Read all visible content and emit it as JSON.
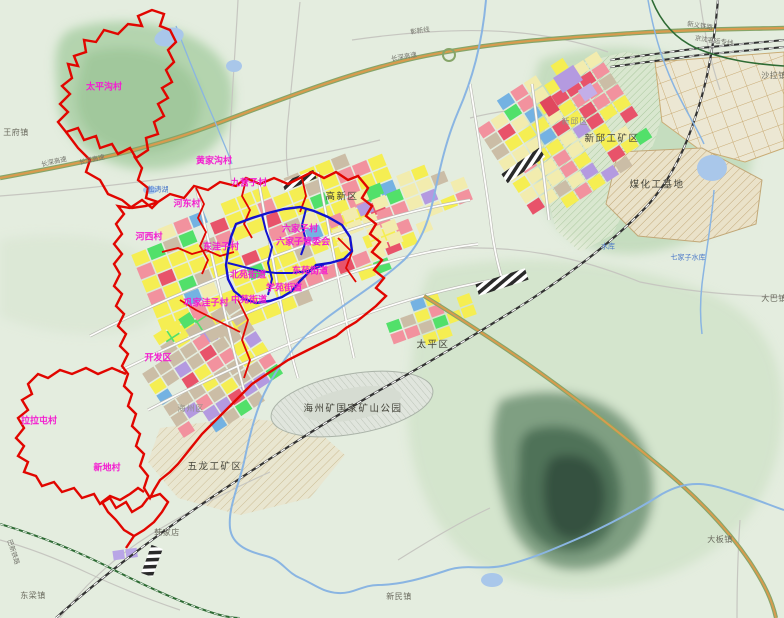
{
  "map": {
    "kind": "urban-master-plan-map",
    "palette": {
      "boundary_red": "#e10600",
      "boundary_blue": "#1212cf",
      "village_label": "#f31fd0",
      "district_label": "#44443a",
      "town_label": "#6a6a5e",
      "water_label": "#4a78c8",
      "road_label": "#73736b",
      "expressway_core": "#d89b4e",
      "expressway_edge": "#86a569",
      "urban_yellow": "#f5ee52",
      "urban_pale_yellow": "#f2ecae",
      "urban_pink": "#f2929e",
      "urban_red": "#e8536a",
      "urban_green": "#52e06a",
      "urban_tan": "#cbbda6",
      "urban_blue": "#74b2e2",
      "urban_purple": "#b49ae0",
      "water": "#8ab5e2",
      "forest": "#9cc497",
      "dark_mountain": "#4f7259"
    },
    "labels": [
      {
        "name": "village-taipinggou",
        "text": "太平沟村",
        "type": "village",
        "x": 104,
        "y": 88
      },
      {
        "name": "village-huangjiagou",
        "text": "黄家沟村",
        "type": "village",
        "x": 214,
        "y": 162
      },
      {
        "name": "village-jiuyingzi",
        "text": "九营子村",
        "type": "village",
        "x": 249,
        "y": 184
      },
      {
        "name": "village-hedong",
        "text": "河东村",
        "type": "village",
        "x": 187,
        "y": 205
      },
      {
        "name": "village-hexi",
        "text": "河西村",
        "type": "village",
        "x": 149,
        "y": 238
      },
      {
        "name": "village-dongwazi",
        "text": "东洼子村",
        "type": "village",
        "x": 221,
        "y": 248
      },
      {
        "name": "village-liujiazi",
        "text": "六家子村",
        "type": "village",
        "x": 300,
        "y": 230
      },
      {
        "name": "committee-liujiazi",
        "text": "六家子管委会",
        "type": "village",
        "x": 303,
        "y": 243
      },
      {
        "name": "subdistrict-beiyuan",
        "text": "北苑街道",
        "type": "village",
        "x": 248,
        "y": 276
      },
      {
        "name": "subdistrict-dongyuan",
        "text": "东苑街道",
        "type": "village",
        "x": 310,
        "y": 272
      },
      {
        "name": "subdistrict-xueyuan",
        "text": "学苑街道",
        "type": "village",
        "x": 284,
        "y": 289
      },
      {
        "name": "subdistrict-zhongyuan",
        "text": "中苑街道",
        "type": "village",
        "x": 249,
        "y": 301
      },
      {
        "name": "village-gongjiawazi",
        "text": "巩家洼子村",
        "type": "village",
        "x": 206,
        "y": 304
      },
      {
        "name": "zone-kaifaqu",
        "text": "开发区",
        "type": "village",
        "x": 158,
        "y": 359
      },
      {
        "name": "village-lalatun",
        "text": "拉拉屯村",
        "type": "village",
        "x": 39,
        "y": 422
      },
      {
        "name": "village-xindi",
        "text": "新地村",
        "type": "village",
        "x": 107,
        "y": 469
      },
      {
        "name": "district-gaoxinqu",
        "text": "高新区",
        "type": "district",
        "x": 342,
        "y": 197
      },
      {
        "name": "district-taipingqu",
        "text": "太平区",
        "type": "district",
        "x": 433,
        "y": 345
      },
      {
        "name": "district-xinqiu-mining",
        "text": "新邱工矿区",
        "type": "district",
        "x": 612,
        "y": 139
      },
      {
        "name": "district-coal-chemical-base",
        "text": "煤化工基地",
        "type": "district",
        "x": 657,
        "y": 185
      },
      {
        "name": "district-wulong-mining",
        "text": "五龙工矿区",
        "type": "district",
        "x": 215,
        "y": 467
      },
      {
        "name": "park-haizhou-mine",
        "text": "海州矿国家矿山公园",
        "type": "district",
        "x": 353,
        "y": 409
      },
      {
        "name": "district-haizhouqu",
        "text": "海州区",
        "type": "district-faint",
        "x": 191,
        "y": 409
      },
      {
        "name": "district-xinqiuqu",
        "text": "新邱区",
        "type": "district-faint",
        "x": 575,
        "y": 122
      },
      {
        "name": "town-wangfu",
        "text": "王府镇",
        "type": "town",
        "x": 16,
        "y": 133
      },
      {
        "name": "town-dongliang",
        "text": "东梁镇",
        "type": "town",
        "x": 33,
        "y": 596
      },
      {
        "name": "town-xinmin",
        "text": "新民镇",
        "type": "town",
        "x": 399,
        "y": 597
      },
      {
        "name": "town-daban",
        "text": "大板镇",
        "type": "town",
        "x": 720,
        "y": 540
      },
      {
        "name": "town-daba",
        "text": "大巴镇",
        "type": "town",
        "x": 774,
        "y": 299
      },
      {
        "name": "town-shala",
        "text": "沙拉镇",
        "type": "town",
        "x": 774,
        "y": 76
      },
      {
        "name": "town-hanjiadian",
        "text": "韩家店",
        "type": "town",
        "x": 167,
        "y": 533
      },
      {
        "name": "water-songtao-lake",
        "text": "松涛湖",
        "type": "water",
        "x": 158,
        "y": 190
      },
      {
        "name": "water-qijiazi-reservoir",
        "text": "七家子水库",
        "type": "water",
        "x": 688,
        "y": 258
      },
      {
        "name": "water-reservoir",
        "text": "水库",
        "type": "water",
        "x": 608,
        "y": 247
      },
      {
        "name": "road-changshen-expwy-1",
        "text": "长深高速",
        "type": "road",
        "x": 54,
        "y": 162,
        "rot": -13
      },
      {
        "name": "road-changshen-expwy-2",
        "text": "长深高速",
        "type": "road",
        "x": 92,
        "y": 160,
        "rot": -13
      },
      {
        "name": "road-changshen-expwy-3",
        "text": "长深高速",
        "type": "road",
        "x": 404,
        "y": 57,
        "rot": -10
      },
      {
        "name": "road-zhangxin-line",
        "text": "彰新线",
        "type": "road",
        "x": 420,
        "y": 31,
        "rot": -8
      },
      {
        "name": "road-xinyi-railway",
        "text": "新义铁路",
        "type": "road",
        "x": 700,
        "y": 26,
        "rot": 9
      },
      {
        "name": "road-jingshen-hsr",
        "text": "京沈客运专线",
        "type": "road",
        "x": 714,
        "y": 41,
        "rot": 8
      },
      {
        "name": "road-baxin-railway",
        "text": "巴新铁路",
        "type": "road",
        "x": 13,
        "y": 552,
        "rot": 72
      }
    ]
  }
}
